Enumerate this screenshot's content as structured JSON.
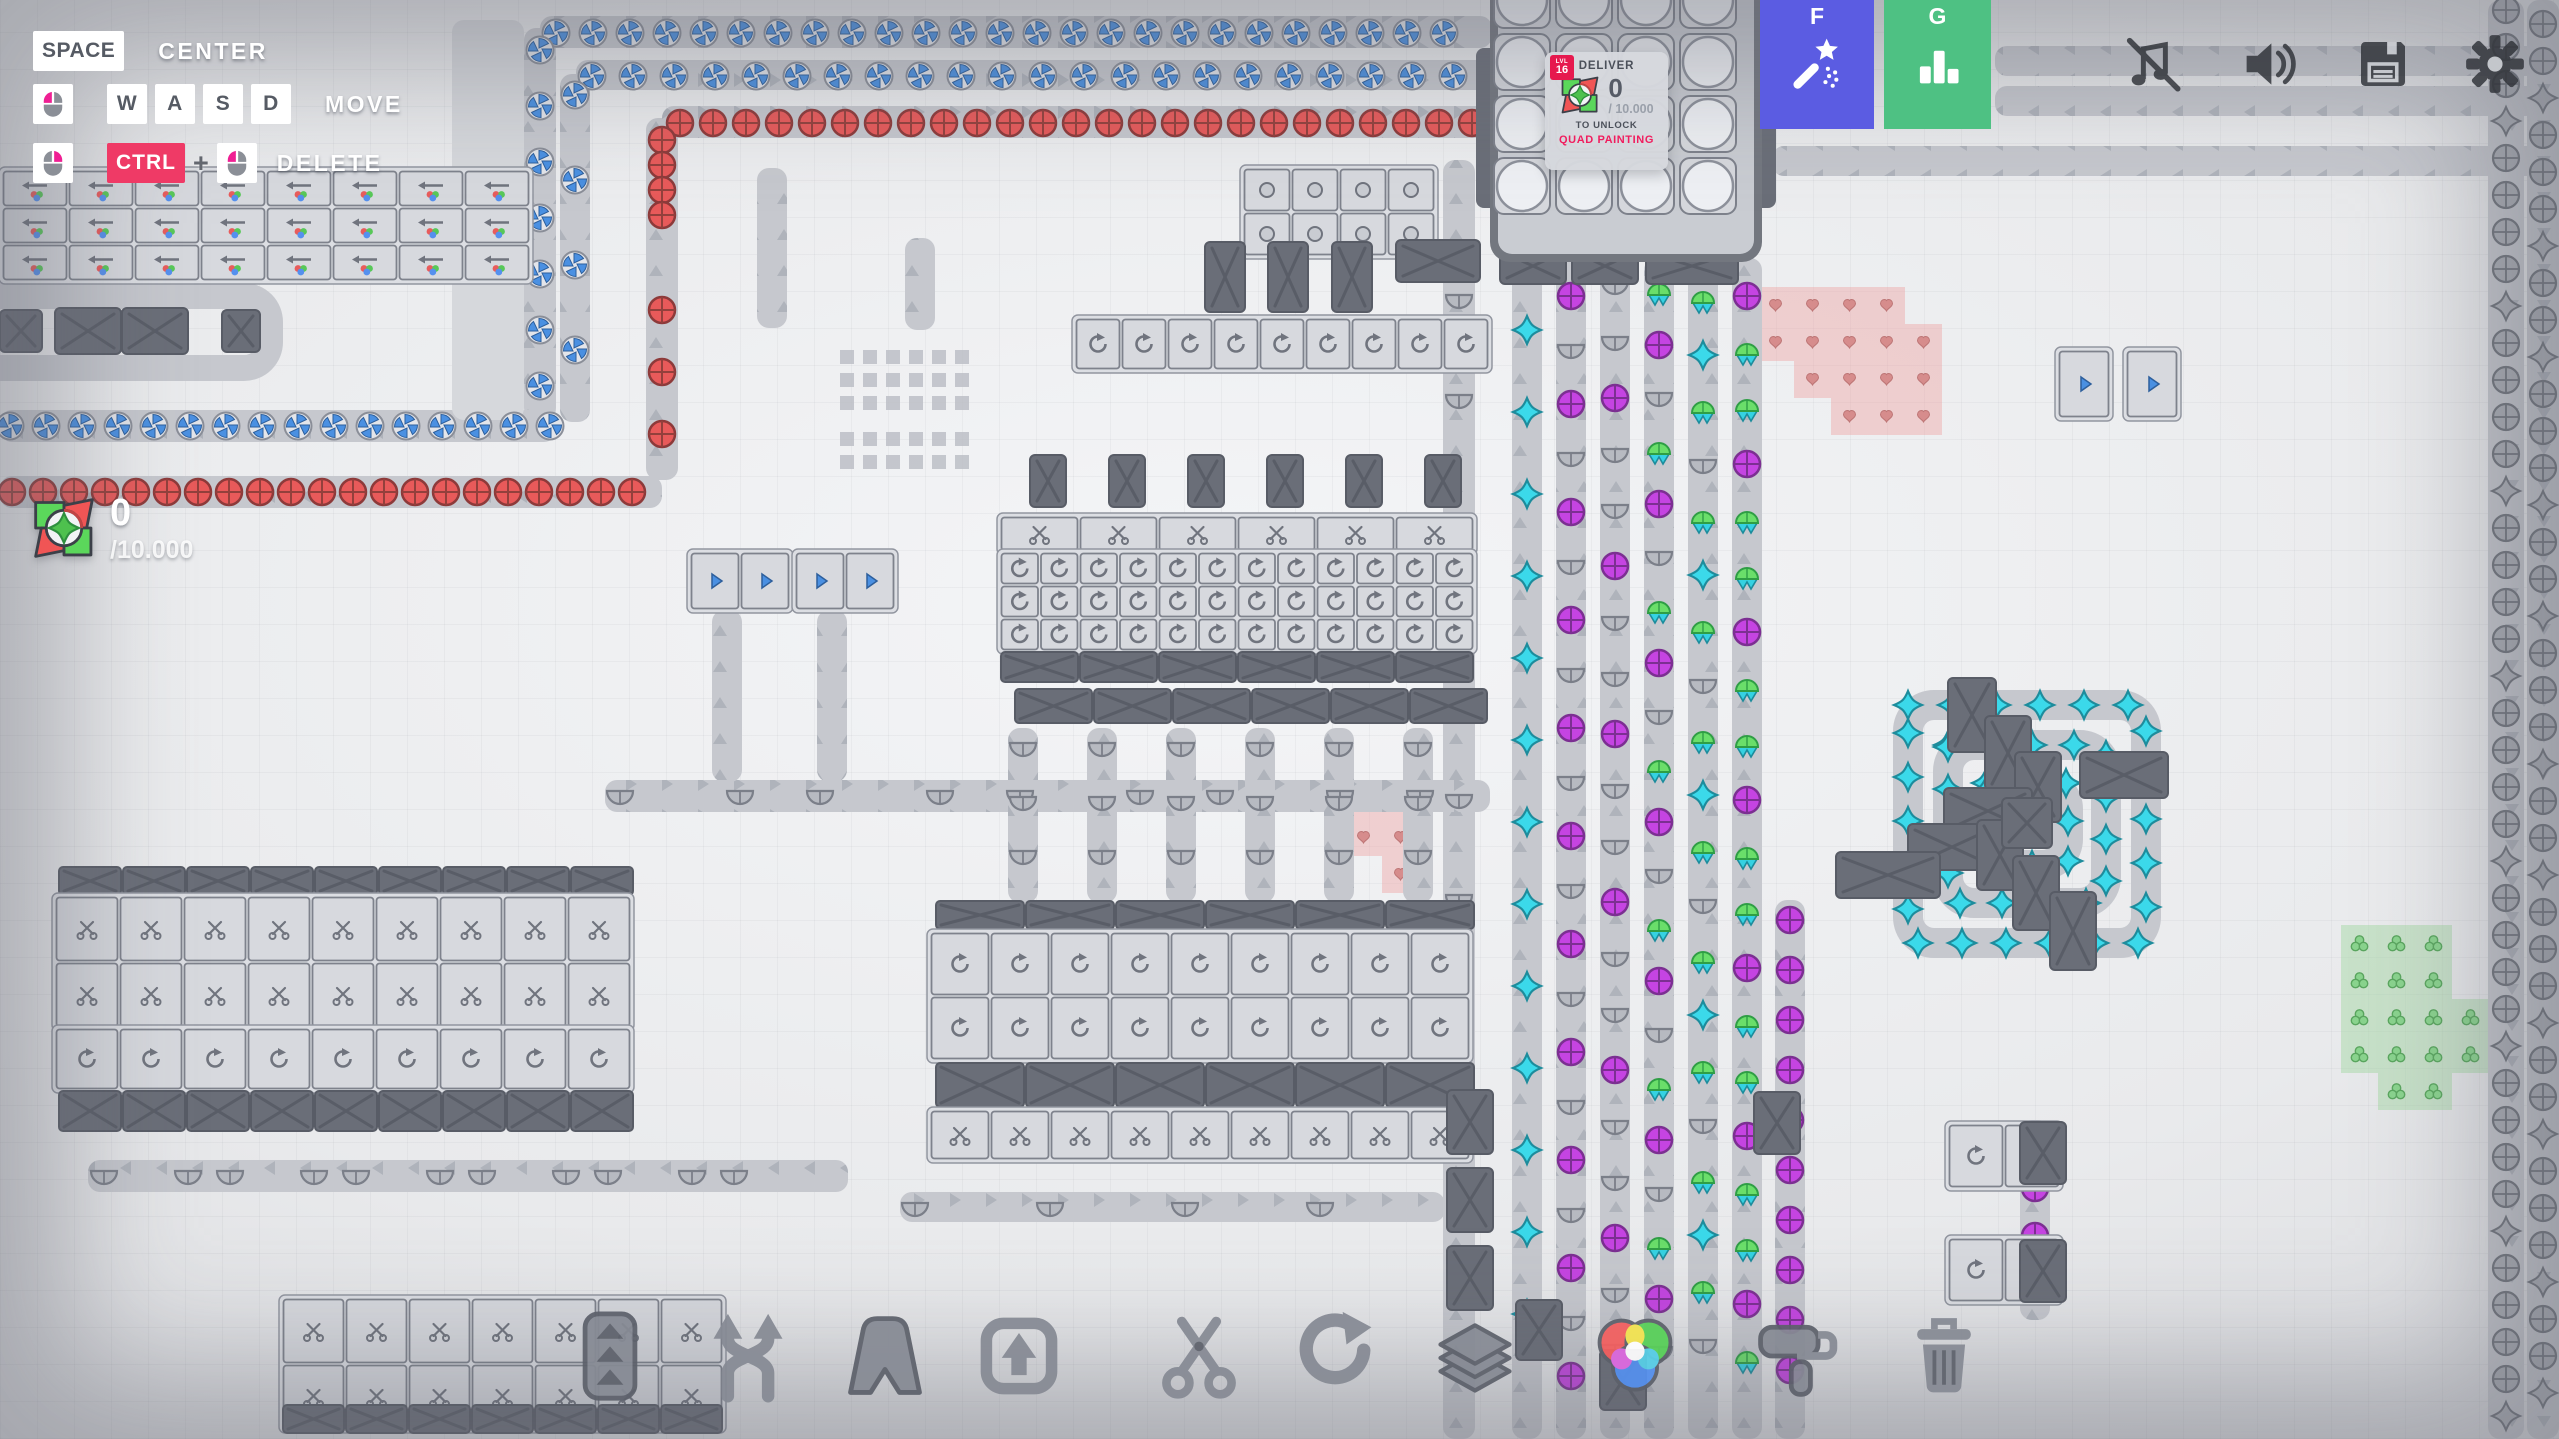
{
  "hud": {
    "hints": {
      "row1": {
        "key": "SPACE",
        "label": "CENTER"
      },
      "row2": {
        "k1": "W",
        "k2": "A",
        "k3": "S",
        "k4": "D",
        "label": "MOVE"
      },
      "row3": {
        "key": "CTRL",
        "plus": "+",
        "label": "DELETE"
      }
    },
    "goal": {
      "level_label": "LVL",
      "level": "16",
      "title": "DELIVER",
      "amount": "0",
      "target": "/ 10.000",
      "unlock_label": "TO UNLOCK",
      "reward": "QUAD PAINTING"
    },
    "counter": {
      "amount": "0",
      "target": "/10.000"
    },
    "hotkeys": [
      {
        "key": "F",
        "icon": "wand",
        "color": "#5b5ce2"
      },
      {
        "key": "G",
        "icon": "stats",
        "color": "#4ec183"
      }
    ],
    "system": [
      "music-muted",
      "volume",
      "save",
      "settings"
    ],
    "toolbar": [
      "belt",
      "balancer",
      "tunnel",
      "lift",
      "cutter",
      "rotator",
      "stacker",
      "painter",
      "roller",
      "trash"
    ],
    "colors": {
      "hotkey_wand": "#5b5ce2",
      "hotkey_stats": "#4ec183",
      "ctrl_key_bg": "#ef3a66",
      "level_badge": "#e6194e",
      "reward_text": "#f01d5e",
      "mouse_accent": "#ef1f93"
    }
  },
  "scene": {
    "colors": {
      "belt": "#c6c8ce",
      "belt_light": "#d6d8dc",
      "machine_light": "#d7d9de",
      "machine_stroke": "#7e828c",
      "dark": "#6a6e78",
      "dark_stroke": "#585c66",
      "blue": "#4a90e2",
      "red": "#e85a5a",
      "purple": "#c544e2",
      "gray_item": "#abaeb5",
      "cyan": "#3bd9ea",
      "green": "#6ade6a",
      "heart": "#d68c8c",
      "berry": "#8ad48e",
      "patch_pink": "rgba(238,160,160,0.42)",
      "patch_green": "rgba(160,216,160,0.45)"
    },
    "belts": [
      [
        524,
        28,
        32,
        392,
        "u"
      ],
      [
        540,
        16,
        952,
        32,
        "r"
      ],
      [
        0,
        410,
        556,
        32,
        "l"
      ],
      [
        560,
        74,
        30,
        348,
        "u"
      ],
      [
        576,
        60,
        916,
        30,
        "r"
      ],
      [
        646,
        118,
        32,
        362,
        "u"
      ],
      [
        662,
        106,
        830,
        32,
        "r"
      ],
      [
        0,
        476,
        662,
        32,
        "l"
      ],
      [
        452,
        20,
        72,
        400,
        "n"
      ],
      [
        1995,
        46,
        564,
        30,
        "l"
      ],
      [
        1995,
        86,
        564,
        30,
        "l"
      ],
      [
        1772,
        146,
        787,
        30,
        "l"
      ],
      [
        2488,
        0,
        36,
        1439,
        "d"
      ],
      [
        2527,
        0,
        32,
        1439,
        "d"
      ],
      [
        1512,
        258,
        30,
        1181,
        "u"
      ],
      [
        1556,
        258,
        30,
        1181,
        "u"
      ],
      [
        1600,
        258,
        30,
        1181,
        "u"
      ],
      [
        1644,
        258,
        30,
        1181,
        "u"
      ],
      [
        1688,
        258,
        30,
        1181,
        "u"
      ],
      [
        1732,
        258,
        30,
        1181,
        "u"
      ],
      [
        1775,
        900,
        30,
        539,
        "u"
      ],
      [
        1443,
        160,
        32,
        1279,
        "u"
      ],
      [
        605,
        780,
        885,
        32,
        "r"
      ],
      [
        88,
        1160,
        760,
        32,
        "l"
      ],
      [
        900,
        1192,
        545,
        30,
        "r"
      ],
      [
        1008,
        728,
        30,
        175,
        "u"
      ],
      [
        1087,
        728,
        30,
        175,
        "u"
      ],
      [
        1166,
        728,
        30,
        175,
        "u"
      ],
      [
        1245,
        728,
        30,
        175,
        "u"
      ],
      [
        1324,
        728,
        30,
        175,
        "u"
      ],
      [
        1403,
        728,
        30,
        175,
        "u"
      ],
      [
        712,
        610,
        30,
        172,
        "u"
      ],
      [
        817,
        610,
        30,
        172,
        "u"
      ],
      [
        757,
        168,
        30,
        160,
        "u"
      ],
      [
        905,
        238,
        30,
        92,
        "u"
      ],
      [
        2020,
        1120,
        30,
        200,
        "u"
      ]
    ],
    "rings": [
      {
        "x": -30,
        "y": 296,
        "w": 300,
        "h": 72,
        "t": 26
      },
      {
        "x": 1908,
        "y": 705,
        "w": 238,
        "h": 238,
        "t": 30,
        "item": "star-cyan",
        "step": 44
      },
      {
        "x": 1948,
        "y": 745,
        "w": 158,
        "h": 158,
        "t": 30,
        "item": "star-cyan",
        "step": 42
      },
      {
        "x": 1986,
        "y": 783,
        "w": 82,
        "h": 82,
        "t": 30,
        "item": "star-cyan",
        "step": 40
      }
    ],
    "runs": [
      {
        "g": [
          "windmill"
        ],
        "x": 556,
        "y": 33,
        "dx": 37,
        "dy": 0,
        "n": 25
      },
      {
        "g": [
          "windmill"
        ],
        "x": 592,
        "y": 76,
        "dx": 41,
        "dy": 0,
        "n": 22
      },
      {
        "g": [
          "circle-red"
        ],
        "x": 680,
        "y": 123,
        "dx": 33,
        "dy": 0,
        "n": 25
      },
      {
        "g": [
          "windmill"
        ],
        "x": 540,
        "y": 50,
        "dx": 0,
        "dy": 56,
        "n": 7
      },
      {
        "g": [
          "windmill"
        ],
        "x": 575,
        "y": 95,
        "dx": 0,
        "dy": 85,
        "n": 4
      },
      {
        "g": [
          "circle-red"
        ],
        "x": 662,
        "y": 140,
        "dx": 0,
        "dy": 25,
        "n": 4
      },
      {
        "g": [
          "circle-red"
        ],
        "x": 662,
        "y": 310,
        "dx": 0,
        "dy": 62,
        "n": 3
      },
      {
        "g": [
          "windmill"
        ],
        "x": 10,
        "y": 426,
        "dx": 36,
        "dy": 0,
        "n": 16
      },
      {
        "g": [
          "circle-red"
        ],
        "x": 12,
        "y": 492,
        "dx": 31,
        "dy": 0,
        "n": 21
      },
      {
        "g": [
          "star-cyan"
        ],
        "x": 1527,
        "y": 330,
        "dx": 0,
        "dy": 82,
        "n": 13
      },
      {
        "g": [
          "circle-purple",
          "half"
        ],
        "x": 1571,
        "y": 296,
        "dx": 0,
        "dy": 54,
        "n": 21
      },
      {
        "g": [
          "half",
          "half",
          "circle-purple"
        ],
        "x": 1615,
        "y": 286,
        "dx": 0,
        "dy": 56,
        "n": 20
      },
      {
        "g": [
          "pine",
          "circle-purple",
          "half"
        ],
        "x": 1659,
        "y": 292,
        "dx": 0,
        "dy": 53,
        "n": 21
      },
      {
        "g": [
          "pine",
          "star-cyan",
          "pine",
          "half"
        ],
        "x": 1703,
        "y": 300,
        "dx": 0,
        "dy": 55,
        "n": 20
      },
      {
        "g": [
          "circle-purple",
          "pine",
          "pine"
        ],
        "x": 1747,
        "y": 296,
        "dx": 0,
        "dy": 56,
        "n": 20
      },
      {
        "g": [
          "circle-purple"
        ],
        "x": 1790,
        "y": 920,
        "dx": 0,
        "dy": 50,
        "n": 10
      },
      {
        "g": [
          "half",
          "-",
          "half",
          "-",
          "-"
        ],
        "x": 1459,
        "y": 300,
        "dx": 0,
        "dy": 50,
        "n": 14
      },
      {
        "g": [
          "circle-gray",
          "circle-gray",
          "circle-gray",
          "star-gray",
          "circle-gray"
        ],
        "x": 2506,
        "y": 10,
        "dx": 0,
        "dy": 37,
        "n": 39
      },
      {
        "g": [
          "circle-gray",
          "circle-gray",
          "star-gray",
          "circle-gray",
          "circle-gray",
          "circle-gray",
          "star-gray"
        ],
        "x": 2543,
        "y": 24,
        "dx": 0,
        "dy": 37,
        "n": 38
      },
      {
        "g": [
          "half",
          "-",
          "-",
          "half",
          "-"
        ],
        "x": 620,
        "y": 796,
        "dx": 40,
        "dy": 0,
        "n": 21
      },
      {
        "g": [
          "half",
          "-",
          "half"
        ],
        "x": 104,
        "y": 1176,
        "dx": 42,
        "dy": 0,
        "n": 16
      },
      {
        "g": [
          "half",
          "-",
          "-"
        ],
        "x": 915,
        "y": 1208,
        "dx": 45,
        "dy": 0,
        "n": 12
      },
      {
        "g": [
          "half"
        ],
        "x": 1023,
        "y": 748,
        "dx": 79,
        "dy": 0,
        "n": 6
      },
      {
        "g": [
          "half"
        ],
        "x": 1023,
        "y": 802,
        "dx": 79,
        "dy": 0,
        "n": 6
      },
      {
        "g": [
          "half"
        ],
        "x": 1023,
        "y": 856,
        "dx": 79,
        "dy": 0,
        "n": 6
      },
      {
        "g": [
          "circle-purple"
        ],
        "x": 2035,
        "y": 1140,
        "dx": 0,
        "dy": 48,
        "n": 4
      }
    ],
    "clusters": [
      {
        "x": 2,
        "y": 170,
        "cols": 8,
        "rows": 3,
        "cw": 66,
        "ch": 37,
        "style": "painter"
      },
      {
        "x": 1000,
        "y": 516,
        "cols": 6,
        "rows": 1,
        "cw": 79,
        "ch": 36,
        "style": "cutter"
      },
      {
        "x": 1000,
        "y": 552,
        "cols": 12,
        "rows": 3,
        "cw": 39.5,
        "ch": 33,
        "style": "rotator"
      },
      {
        "x": 1000,
        "y": 651,
        "cols": 6,
        "rows": 1,
        "cw": 79,
        "ch": 32,
        "style": "dark"
      },
      {
        "x": 1014,
        "y": 688,
        "cols": 6,
        "rows": 1,
        "cw": 79,
        "ch": 36,
        "style": "dark"
      },
      {
        "x": 935,
        "y": 900,
        "cols": 6,
        "rows": 1,
        "cw": 90,
        "ch": 30,
        "style": "dark"
      },
      {
        "x": 930,
        "y": 932,
        "cols": 9,
        "rows": 2,
        "cw": 60,
        "ch": 64,
        "style": "rotator"
      },
      {
        "x": 935,
        "y": 1062,
        "cols": 6,
        "rows": 1,
        "cw": 90,
        "ch": 46,
        "style": "dark"
      },
      {
        "x": 930,
        "y": 1110,
        "cols": 9,
        "rows": 1,
        "cw": 60,
        "ch": 50,
        "style": "cutter"
      },
      {
        "x": 58,
        "y": 866,
        "cols": 9,
        "rows": 1,
        "cw": 64,
        "ch": 30,
        "style": "dark"
      },
      {
        "x": 55,
        "y": 896,
        "cols": 9,
        "rows": 2,
        "cw": 64,
        "ch": 66,
        "style": "cutter"
      },
      {
        "x": 55,
        "y": 1028,
        "cols": 9,
        "rows": 1,
        "cw": 64,
        "ch": 62,
        "style": "rotator"
      },
      {
        "x": 58,
        "y": 1090,
        "cols": 9,
        "rows": 1,
        "cw": 64,
        "ch": 42,
        "style": "dark"
      },
      {
        "x": 1243,
        "y": 168,
        "cols": 4,
        "rows": 2,
        "cw": 48,
        "ch": 44,
        "style": "dot"
      },
      {
        "x": 1075,
        "y": 318,
        "cols": 9,
        "rows": 1,
        "cw": 46,
        "ch": 52,
        "style": "rotator"
      },
      {
        "x": 282,
        "y": 1298,
        "cols": 7,
        "rows": 2,
        "cw": 63,
        "ch": 66,
        "style": "cutter"
      },
      {
        "x": 282,
        "y": 1404,
        "cols": 7,
        "rows": 1,
        "cw": 63,
        "ch": 30,
        "style": "dark"
      },
      {
        "x": 690,
        "y": 552,
        "cols": 2,
        "rows": 1,
        "cw": 50,
        "ch": 58,
        "style": "filter"
      },
      {
        "x": 795,
        "y": 552,
        "cols": 2,
        "rows": 1,
        "cw": 50,
        "ch": 58,
        "style": "filter"
      },
      {
        "x": 2058,
        "y": 350,
        "cols": 1,
        "rows": 1,
        "cw": 52,
        "ch": 68,
        "style": "filter"
      },
      {
        "x": 2126,
        "y": 350,
        "cols": 1,
        "rows": 1,
        "cw": 52,
        "ch": 68,
        "style": "filter"
      },
      {
        "x": 1948,
        "y": 1124,
        "cols": 2,
        "rows": 1,
        "cw": 56,
        "ch": 64,
        "style": "rotator"
      },
      {
        "x": 1948,
        "y": 1238,
        "cols": 2,
        "rows": 1,
        "cw": 56,
        "ch": 64,
        "style": "rotator"
      }
    ],
    "blocks": [
      [
        0,
        310,
        42,
        42
      ],
      [
        55,
        308,
        66,
        46
      ],
      [
        122,
        308,
        66,
        46
      ],
      [
        222,
        310,
        38,
        42
      ],
      [
        1500,
        248,
        66,
        36
      ],
      [
        1572,
        248,
        66,
        36
      ],
      [
        1646,
        248,
        92,
        36
      ],
      [
        1205,
        242,
        40,
        70
      ],
      [
        1268,
        242,
        40,
        70
      ],
      [
        1332,
        242,
        40,
        70
      ],
      [
        1396,
        240,
        84,
        42
      ],
      [
        1948,
        678,
        48,
        74
      ],
      [
        1985,
        716,
        46,
        74
      ],
      [
        2015,
        752,
        46,
        70
      ],
      [
        2080,
        752,
        88,
        46
      ],
      [
        1944,
        788,
        88,
        46
      ],
      [
        1908,
        824,
        88,
        46
      ],
      [
        1977,
        820,
        46,
        70
      ],
      [
        2013,
        856,
        46,
        74
      ],
      [
        2050,
        892,
        46,
        78
      ],
      [
        1836,
        852,
        104,
        46
      ],
      [
        2002,
        798,
        50,
        50
      ],
      [
        1447,
        1090,
        46,
        64
      ],
      [
        1447,
        1168,
        46,
        64
      ],
      [
        1447,
        1246,
        46,
        64
      ],
      [
        1754,
        1092,
        46,
        62
      ],
      [
        2020,
        1122,
        46,
        62
      ],
      [
        2020,
        1240,
        46,
        62
      ],
      [
        1030,
        455,
        36,
        52
      ],
      [
        1109,
        455,
        36,
        52
      ],
      [
        1188,
        455,
        36,
        52
      ],
      [
        1267,
        455,
        36,
        52
      ],
      [
        1346,
        455,
        36,
        52
      ],
      [
        1425,
        455,
        36,
        52
      ],
      [
        1516,
        1300,
        46,
        60
      ],
      [
        1600,
        1350,
        46,
        60
      ]
    ],
    "patches": [
      {
        "x": 1757,
        "y": 287,
        "t": 37,
        "color": "pink",
        "dot": "heart",
        "cells": [
          [
            0,
            0
          ],
          [
            1,
            0
          ],
          [
            2,
            0
          ],
          [
            3,
            0
          ],
          [
            0,
            1
          ],
          [
            1,
            1
          ],
          [
            2,
            1
          ],
          [
            3,
            1
          ],
          [
            4,
            1
          ],
          [
            1,
            2
          ],
          [
            2,
            2
          ],
          [
            3,
            2
          ],
          [
            4,
            2
          ],
          [
            2,
            3
          ],
          [
            3,
            3
          ],
          [
            4,
            3
          ]
        ]
      },
      {
        "x": 1345,
        "y": 782,
        "t": 37,
        "color": "pink",
        "dot": "heart",
        "cells": [
          [
            0,
            0
          ],
          [
            1,
            0
          ],
          [
            0,
            1
          ],
          [
            1,
            1
          ],
          [
            1,
            2
          ]
        ]
      },
      {
        "x": 2341,
        "y": 925,
        "t": 37,
        "color": "green",
        "dot": "berry",
        "cells": [
          [
            0,
            0
          ],
          [
            1,
            0
          ],
          [
            2,
            0
          ],
          [
            0,
            1
          ],
          [
            1,
            1
          ],
          [
            2,
            1
          ],
          [
            0,
            2
          ],
          [
            1,
            2
          ],
          [
            2,
            2
          ],
          [
            3,
            2
          ],
          [
            0,
            3
          ],
          [
            1,
            3
          ],
          [
            2,
            3
          ],
          [
            3,
            3
          ],
          [
            1,
            4
          ],
          [
            2,
            4
          ]
        ]
      }
    ],
    "dot_grids": [
      {
        "x": 840,
        "y": 350,
        "cols": 6,
        "rows": 3,
        "size": 14,
        "gap": 9
      },
      {
        "x": 840,
        "y": 432,
        "cols": 6,
        "rows": 2,
        "size": 14,
        "gap": 9
      }
    ],
    "hub": {
      "x": 1490,
      "y": -26,
      "w": 272,
      "h": 288
    }
  }
}
